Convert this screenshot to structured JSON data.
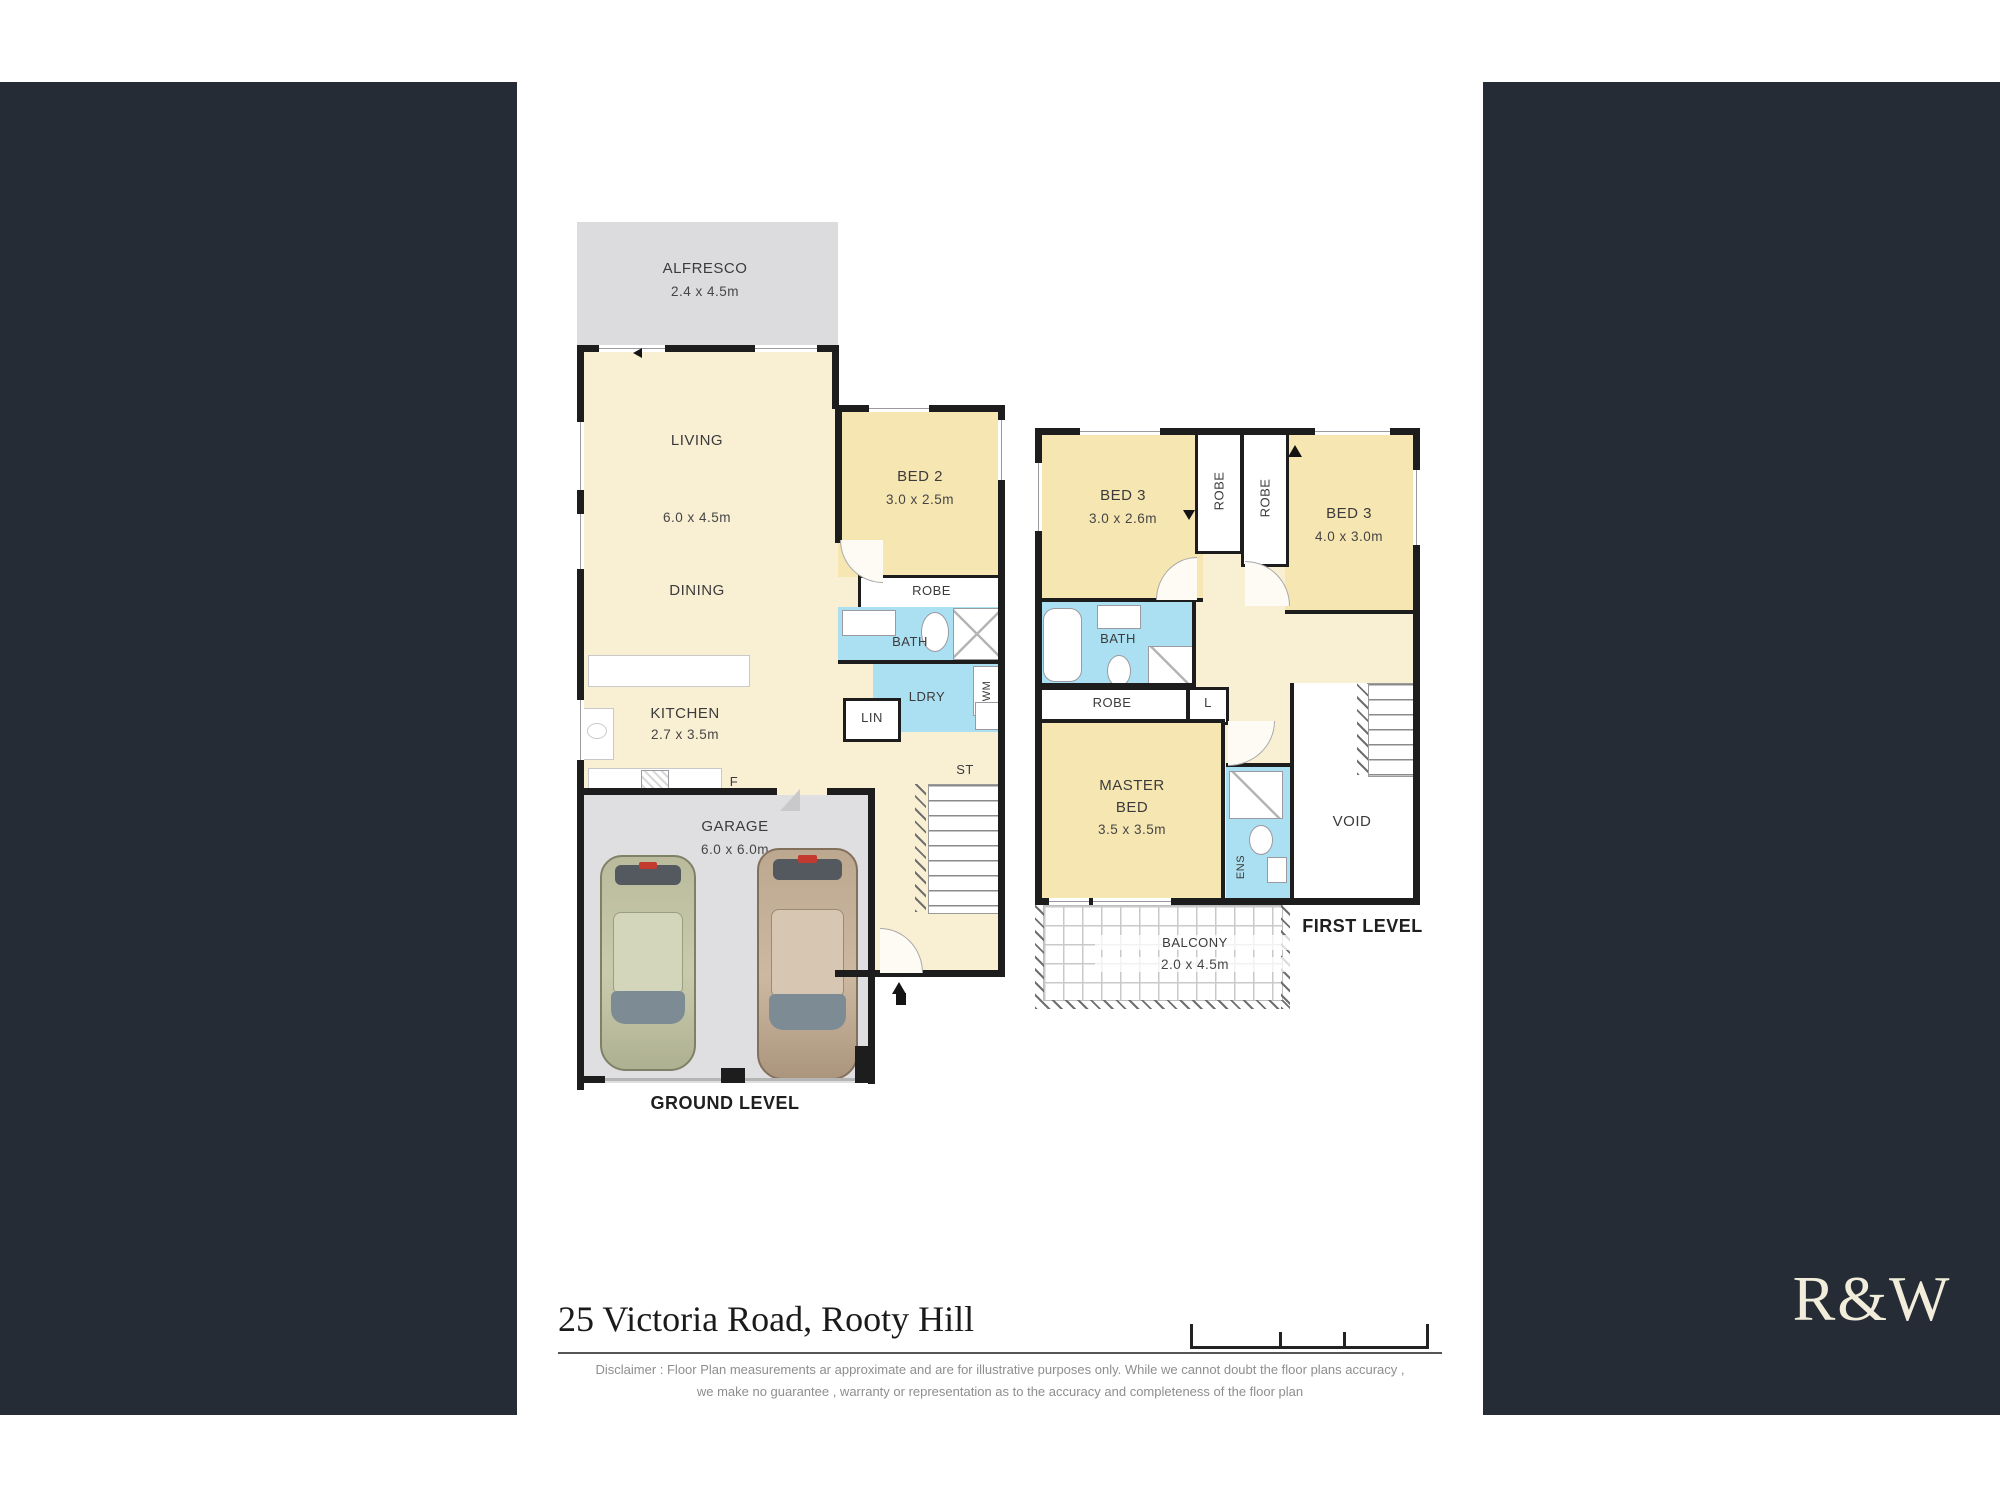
{
  "colors": {
    "panel_navy": "#252c36",
    "room_cream": "#f9efd3",
    "room_bedroom": "#f6e6b2",
    "room_wet_blue": "#abe0f2",
    "slab_gray": "#dcdcde",
    "garage_gray": "#dfdfe1",
    "wall_black": "#1d1d1d"
  },
  "ground": {
    "title": "GROUND LEVEL",
    "alfresco_name": "ALFRESCO",
    "alfresco_dims": "2.4 x 4.5m",
    "living_name": "LIVING",
    "living_dims": "6.0 x 4.5m",
    "dining_name": "DINING",
    "kitchen_name": "KITCHEN",
    "kitchen_dims": "2.7 x 3.5m",
    "fridge": "F",
    "bed2_name": "BED 2",
    "bed2_dims": "3.0 x 2.5m",
    "robe": "ROBE",
    "bath": "BATH",
    "ldry": "LDRY",
    "wm": "WM",
    "lin": "LIN",
    "st": "ST",
    "garage_name": "GARAGE",
    "garage_dims": "6.0 x 6.0m"
  },
  "first": {
    "title": "FIRST LEVEL",
    "bed3_left_name": "BED 3",
    "bed3_left_dims": "3.0 x 2.6m",
    "bed3_right_name": "BED 3",
    "bed3_right_dims": "4.0 x 3.0m",
    "robe_vert_1": "ROBE",
    "robe_vert_2": "ROBE",
    "bath": "BATH",
    "robe_master": "ROBE",
    "linen": "L",
    "master_line1": "MASTER",
    "master_line2": "BED",
    "master_dims": "3.5 x 3.5m",
    "ens": "ENS",
    "void": "VOID",
    "balcony_name": "BALCONY",
    "balcony_dims": "2.0 x 4.5m"
  },
  "footer": {
    "address": "25 Victoria Road, Rooty Hill",
    "disclaimer_line1": "Disclaimer : Floor Plan measurements ar approximate and are for illustrative purposes only. While we cannot doubt the floor plans accuracy ,",
    "disclaimer_line2": "we make no guarantee , warranty or representation as to the accuracy and completeness of the floor plan"
  },
  "logo": {
    "text": "R&W"
  }
}
